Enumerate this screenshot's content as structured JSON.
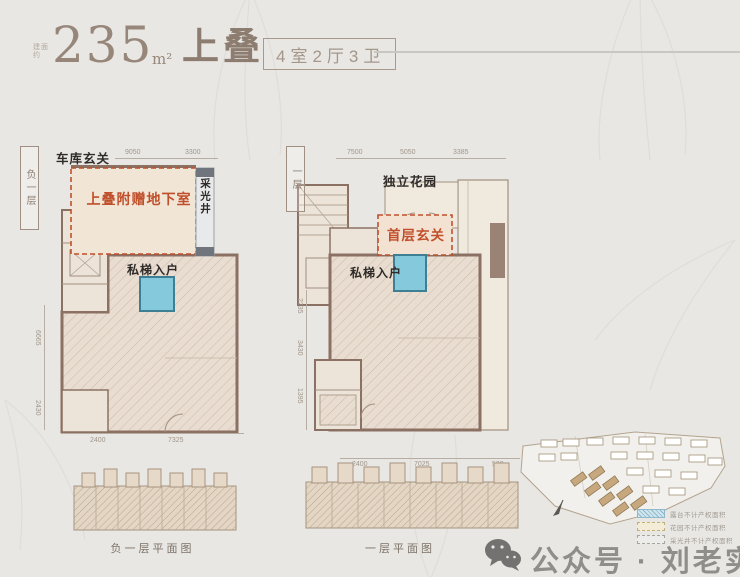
{
  "header": {
    "area_prefix": "建面约",
    "area_value": "235",
    "area_unit": "m²",
    "product_name": "上叠",
    "spec_badge": "4室2厅3卫"
  },
  "plan_basement": {
    "level_tag": "负一层",
    "label_garage_entry": "车库玄关",
    "label_bonus_basement": "上叠附赠地下室",
    "label_light_well": "采光井",
    "label_private_elevator": "私梯入户",
    "dim_top": [
      "9050",
      "3300"
    ],
    "dim_bottom": [
      "2400",
      "7325"
    ],
    "dim_left": [
      "6665",
      "2430"
    ],
    "caption": "负一层平面图"
  },
  "plan_first": {
    "level_tag": "一层",
    "label_garden": "独立花园",
    "label_entry": "首层玄关",
    "label_private_elevator": "私梯入户",
    "dim_top": [
      "7500",
      "5050",
      "3385"
    ],
    "dim_bottom": [
      "2400",
      "7025",
      "530"
    ],
    "dim_left": [
      "2235",
      "3430",
      "1395"
    ],
    "caption": "一层平面图"
  },
  "site_plan": {
    "legend": [
      {
        "label": "露台不计产权面积"
      },
      {
        "label": "花园不计产权面积"
      },
      {
        "label": "采光井不计产权面积"
      }
    ]
  },
  "watermark": {
    "text": "公众号 · 刘老实选房"
  },
  "colors": {
    "accent_red": "#c0502c",
    "wall_brown": "#8b7163",
    "elevator_blue": "#85c9dd",
    "title_brown": "#97877a",
    "background": "#e9e7e3"
  }
}
